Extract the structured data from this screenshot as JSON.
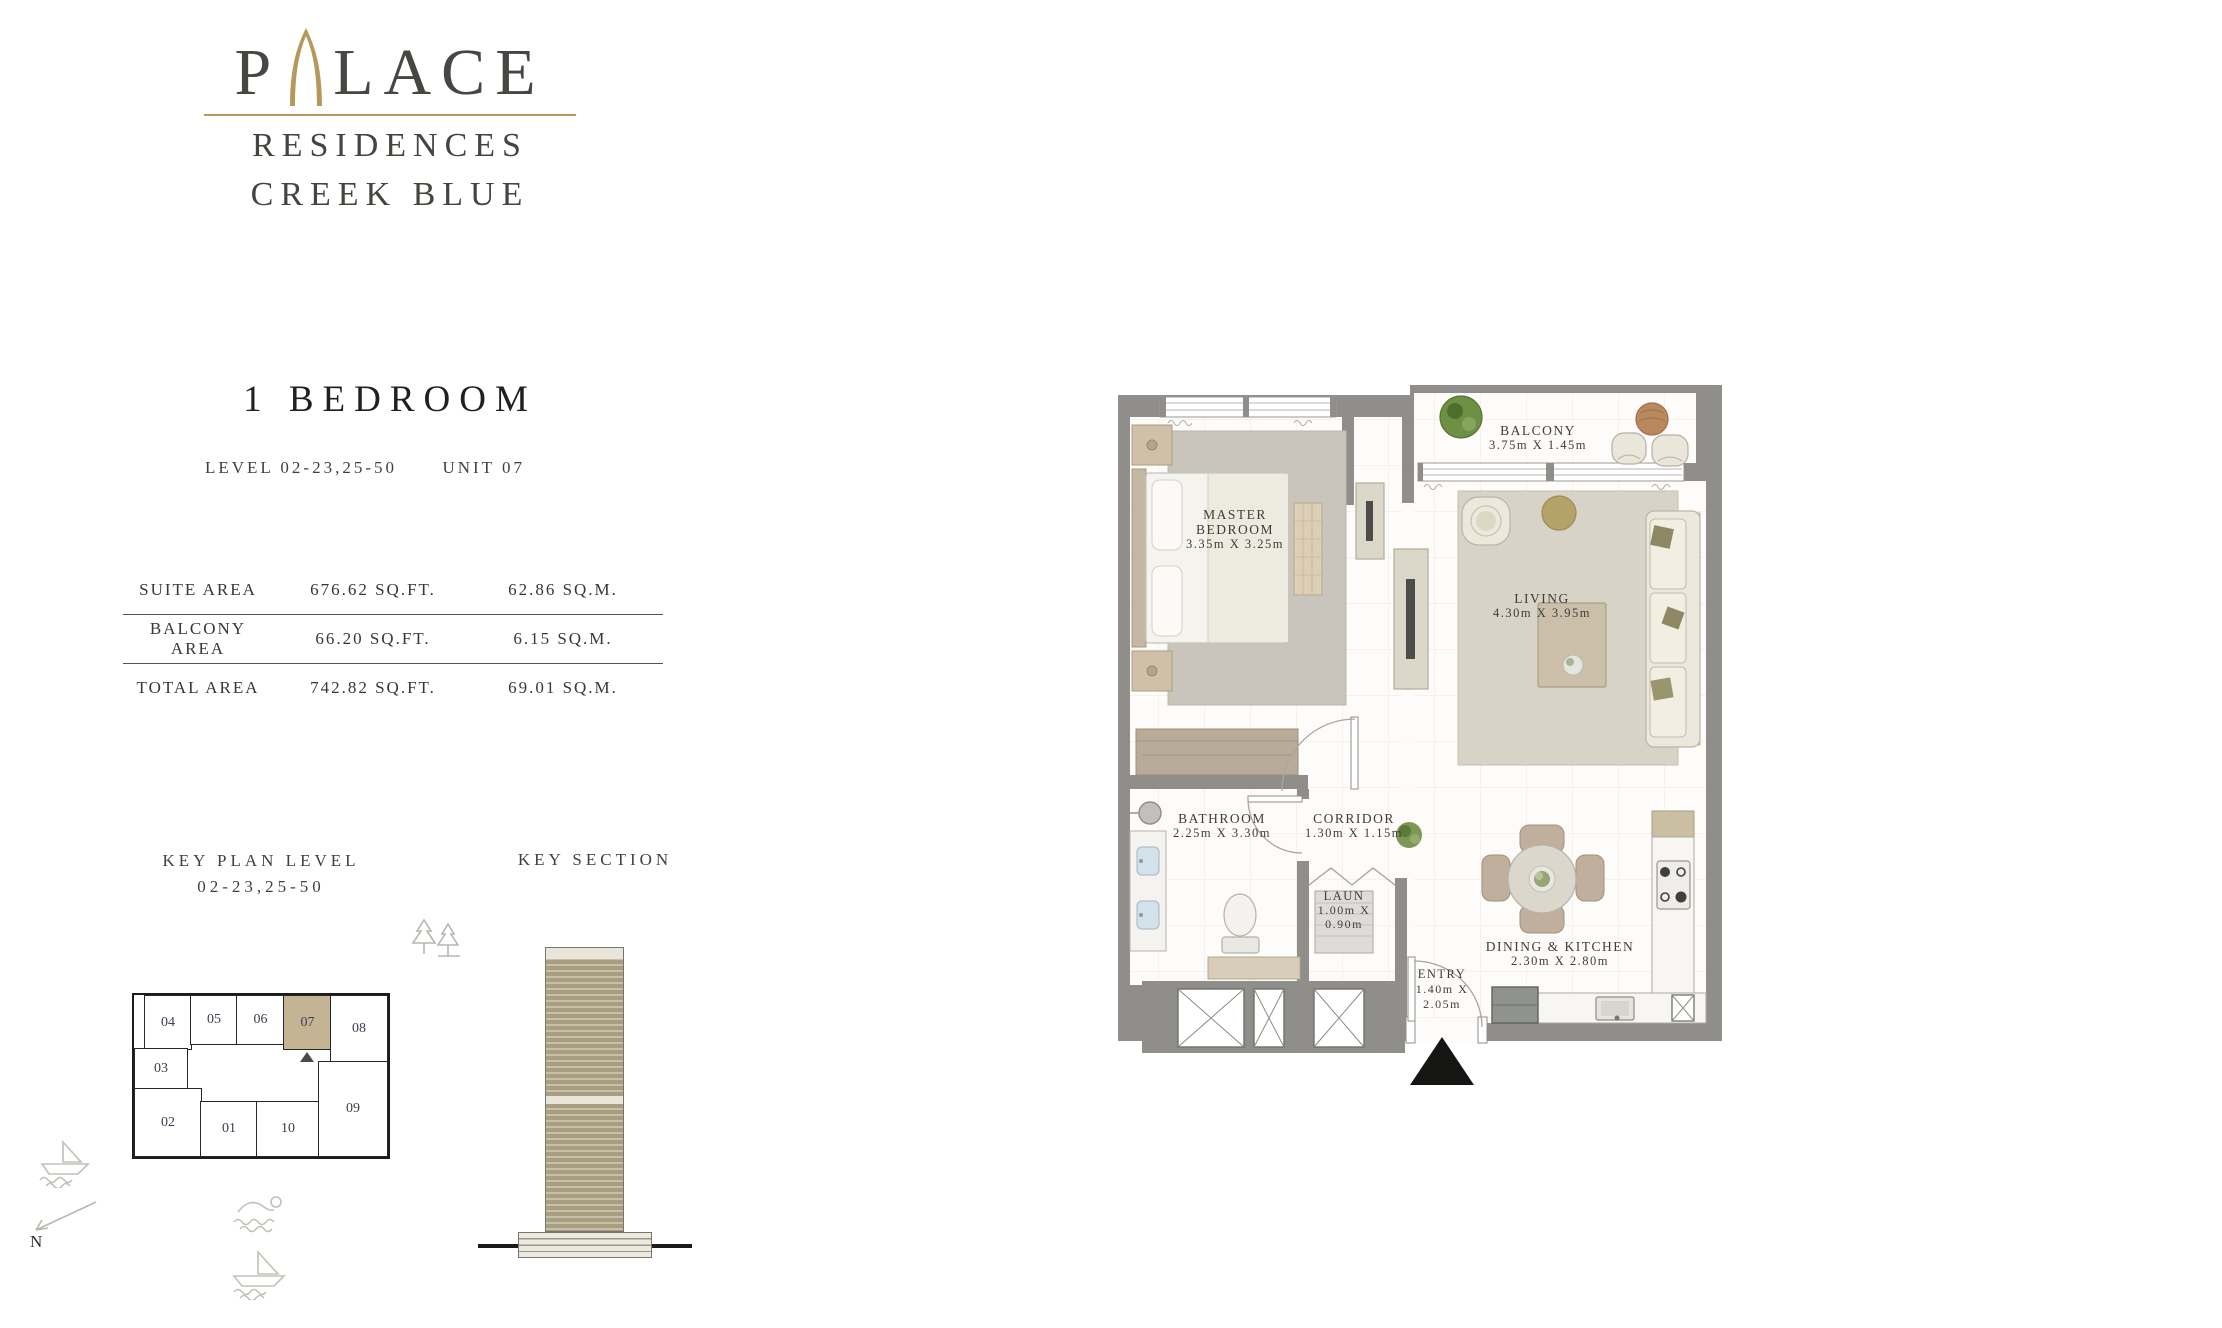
{
  "brand": {
    "word_start": "P",
    "word_end": "LACE",
    "line1": "RESIDENCES",
    "line2": "CREEK BLUE"
  },
  "title": "1 BEDROOM",
  "meta": {
    "level_label": "LEVEL 02-23,25-50",
    "unit_label": "UNIT 07"
  },
  "areas": {
    "rows": [
      {
        "label": "SUITE AREA",
        "sqft": "676.62 SQ.FT.",
        "sqm": "62.86 SQ.M."
      },
      {
        "label": "BALCONY AREA",
        "sqft": "66.20 SQ.FT.",
        "sqm": "6.15 SQ.M."
      },
      {
        "label": "TOTAL AREA",
        "sqft": "742.82 SQ.FT.",
        "sqm": "69.01 SQ.M."
      }
    ]
  },
  "key_plan": {
    "title_line1": "KEY PLAN LEVEL",
    "title_line2": "02-23,25-50",
    "highlighted_unit": "07",
    "units": [
      {
        "label": "04"
      },
      {
        "label": "05"
      },
      {
        "label": "06"
      },
      {
        "label": "07"
      },
      {
        "label": "08"
      },
      {
        "label": "03"
      },
      {
        "label": "02"
      },
      {
        "label": "01"
      },
      {
        "label": "10"
      },
      {
        "label": "09"
      }
    ]
  },
  "key_section": {
    "title": "KEY SECTION"
  },
  "compass": {
    "label": "N"
  },
  "floor_plan": {
    "master_bedroom": {
      "line1": "MASTER",
      "line2": "BEDROOM",
      "dims": "3.35m X 3.25m"
    },
    "balcony": {
      "line1": "BALCONY",
      "dims": "3.75m X 1.45m"
    },
    "living": {
      "line1": "LIVING",
      "dims": "4.30m X 3.95m"
    },
    "bathroom": {
      "line1": "BATHROOM",
      "dims": "2.25m X 3.30m"
    },
    "corridor": {
      "line1": "CORRIDOR",
      "dims": "1.30m X 1.15m"
    },
    "laundry": {
      "line1": "LAUN",
      "dims1": "1.00m X",
      "dims2": "0.90m"
    },
    "entry": {
      "line1": "ENTRY",
      "dims1": "1.40m X",
      "dims2": "2.05m"
    },
    "dining_kitchen": {
      "line1": "DINING & KITCHEN",
      "dims": "2.30m X 2.80m"
    }
  },
  "icons": {
    "arch": "pointed-arch",
    "trees": "pine-trees",
    "boat": "boat-on-waves",
    "swimmer": "swimmer-on-waves",
    "north": "north-arrow",
    "entry_marker": "entry-triangle",
    "unit_marker": "unit-triangle"
  },
  "colors": {
    "wall": "#8f8e8a",
    "floor": "#fdfcfa",
    "highlight_tan": "#c5b493",
    "gold": "#b5985a",
    "ink": "#3f3e3b"
  }
}
